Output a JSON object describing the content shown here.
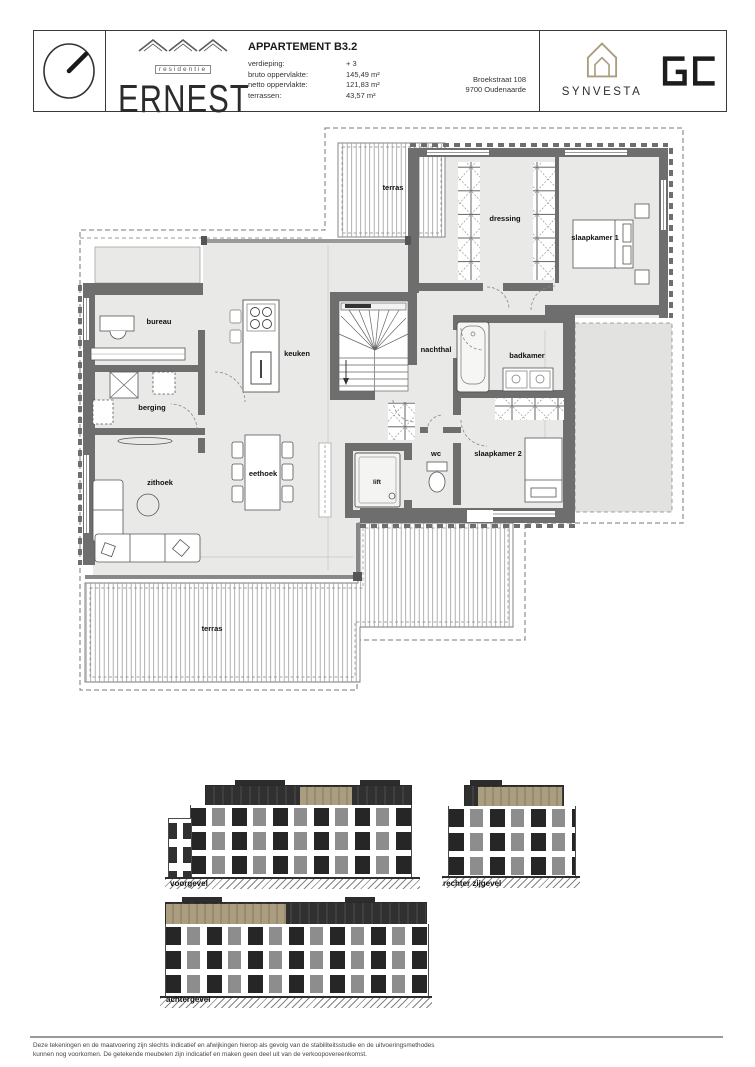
{
  "header": {
    "title": "APPARTEMENT B3.2",
    "specs": [
      {
        "label": "verdieping:",
        "value": "+ 3"
      },
      {
        "label": "bruto oppervlakte:",
        "value": "145,49 m²"
      },
      {
        "label": "netto oppervlakte:",
        "value": "121,83 m²"
      },
      {
        "label": "terrassen:",
        "value": "43,57 m²"
      }
    ],
    "address": {
      "line1": "Broekstraat 108",
      "line2": "9700 Oudenaarde"
    },
    "brand": {
      "sub": "residentie",
      "name": "ERNEST"
    },
    "partners": {
      "synvesta": "SYNVESTA",
      "gc": "GC"
    }
  },
  "plan": {
    "rooms": [
      {
        "label": "terras"
      },
      {
        "label": "dressing"
      },
      {
        "label": "slaapkamer 1"
      },
      {
        "label": "bureau"
      },
      {
        "label": "keuken"
      },
      {
        "label": "nachthal"
      },
      {
        "label": "badkamer"
      },
      {
        "label": "berging"
      },
      {
        "label": "eethoek"
      },
      {
        "label": "wc"
      },
      {
        "label": "slaapkamer 2"
      },
      {
        "label": "zithoek"
      },
      {
        "label": "lift"
      },
      {
        "label": "terras"
      }
    ]
  },
  "elevations": [
    {
      "label": "voorgevel"
    },
    {
      "label": "rechter zijgevel"
    },
    {
      "label": "achtergevel"
    }
  ],
  "footer": {
    "line1": "Deze tekeningen en de maatvoering zijn slechts indicatief en afwijkingen hierop als gevolg van de stabiliteitsstudie en de uitvoeringsmethodes",
    "line2": "kunnen nog voorkomen. De getekende meubelen zijn indicatief en maken geen deel uit van de verkoopovereenkomst."
  },
  "colors": {
    "wall": "#6e6e6e",
    "floor": "#e9e9e7",
    "accent_tan": "#ab9d7f",
    "elevation_dark": "#303030"
  }
}
